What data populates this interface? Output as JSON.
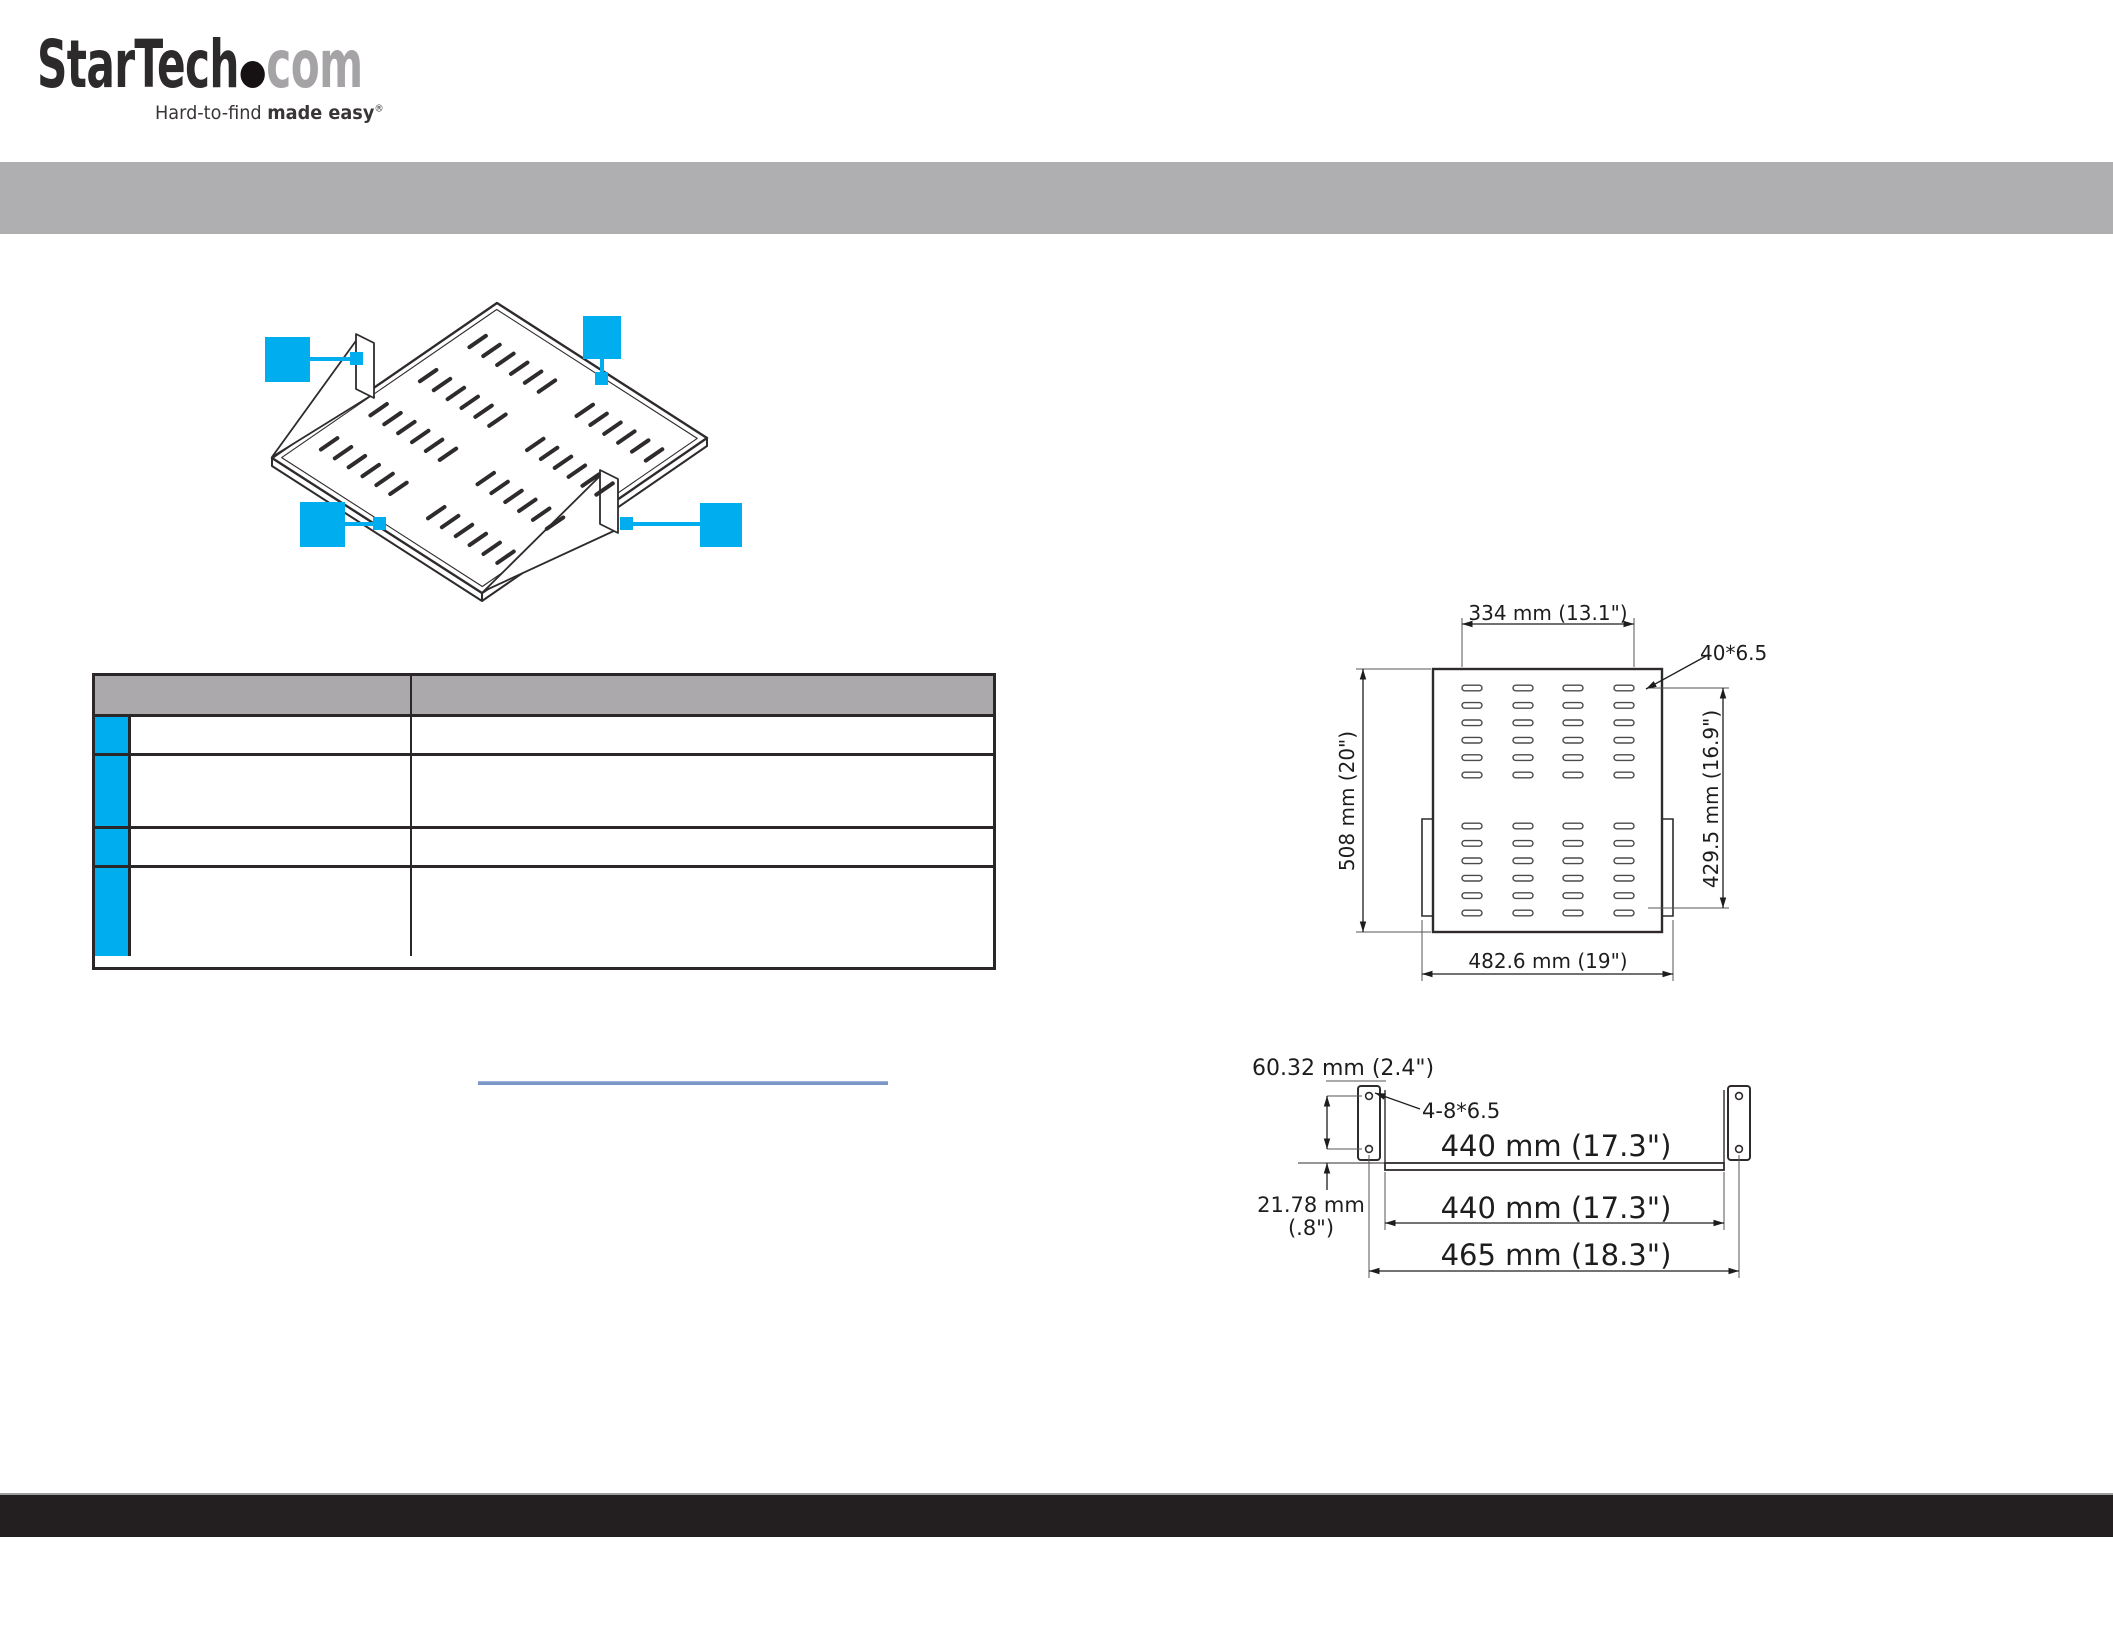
{
  "brand": {
    "name": "StarTech",
    "com": "com",
    "tagline_regular": "Hard-to-find ",
    "tagline_bold": "made easy",
    "registered_mark": "®"
  },
  "colors": {
    "accent_blue": "#00AEEF",
    "band_gray": "#AFAEB0",
    "table_header_gray": "#ABA9AC",
    "footer_black": "#231F20",
    "link_line_blue": "#7B97C7",
    "drawing_stroke": "#2F2B2C"
  },
  "product_diagram": {
    "callouts": [
      {
        "label": ""
      },
      {
        "label": ""
      },
      {
        "label": ""
      },
      {
        "label": ""
      }
    ]
  },
  "spec_table": {
    "header": {
      "col1": "",
      "col2": ""
    },
    "rows": [
      {
        "col1": "",
        "col2": ""
      },
      {
        "col1": "",
        "col2": ""
      },
      {
        "col1": "",
        "col2": ""
      },
      {
        "col1": "",
        "col2": ""
      }
    ]
  },
  "link": {
    "text": ""
  },
  "top_view": {
    "width_dim": "334 mm (13.1\")",
    "slot_label": "40*6.5",
    "height_dim": "508 mm (20\")",
    "inner_height_dim": "429.5 mm (16.9\")",
    "outer_width_dim": "482.6 mm (19\")"
  },
  "front_view": {
    "bracket_height_dim": "60.32 mm (2.4\")",
    "holes_label": "4-8*6.5",
    "shelf_width_dim": "440 mm (17.3\")",
    "mount_width_dim": "440 mm (17.3\")",
    "overall_width_dim": "465 mm (18.3\")",
    "offset_dim_mm": "21.78 mm",
    "offset_dim_in": "(.8\")"
  }
}
